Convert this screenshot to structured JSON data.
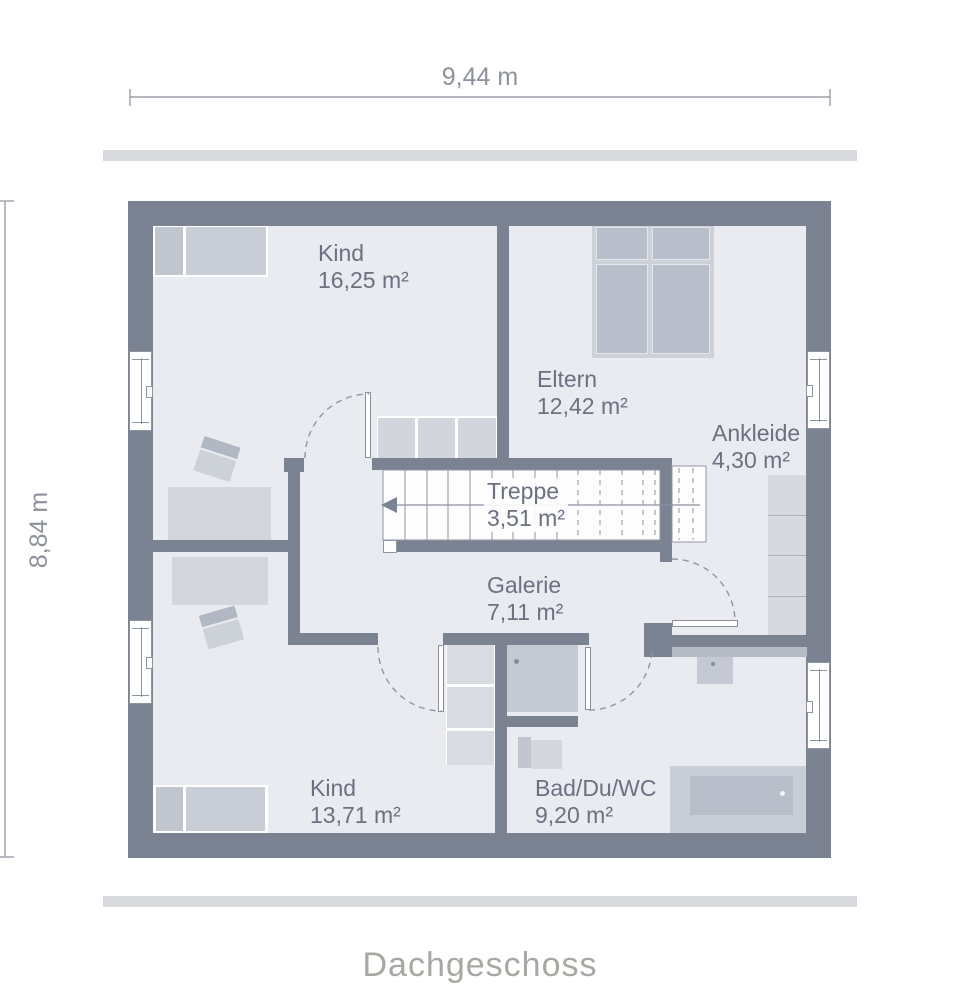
{
  "floor_title": "Dachgeschoss",
  "dimensions": {
    "width_label": "9,44 m",
    "height_label": "8,84 m"
  },
  "rooms": [
    {
      "name": "Kind",
      "area": "16,25 m²"
    },
    {
      "name": "Eltern",
      "area": "12,42 m²"
    },
    {
      "name": "Ankleide",
      "area": "4,30 m²"
    },
    {
      "name": "Treppe",
      "area": "3,51 m²"
    },
    {
      "name": "Galerie",
      "area": "7,11 m²"
    },
    {
      "name": "Kind",
      "area": "13,71 m²"
    },
    {
      "name": "Bad/Du/WC",
      "area": "9,20 m²"
    }
  ],
  "colors": {
    "wall": "#7b8292",
    "floor": "#e9ebf1",
    "accent_bar": "#d8dade",
    "furniture_light": "#d3d6dc",
    "furniture_mid": "#c4c9d3",
    "furniture_dark": "#b7bdc9",
    "label_text": "#6b7180",
    "dimension_text": "#8d919b",
    "title_text": "#a7a8a2"
  }
}
